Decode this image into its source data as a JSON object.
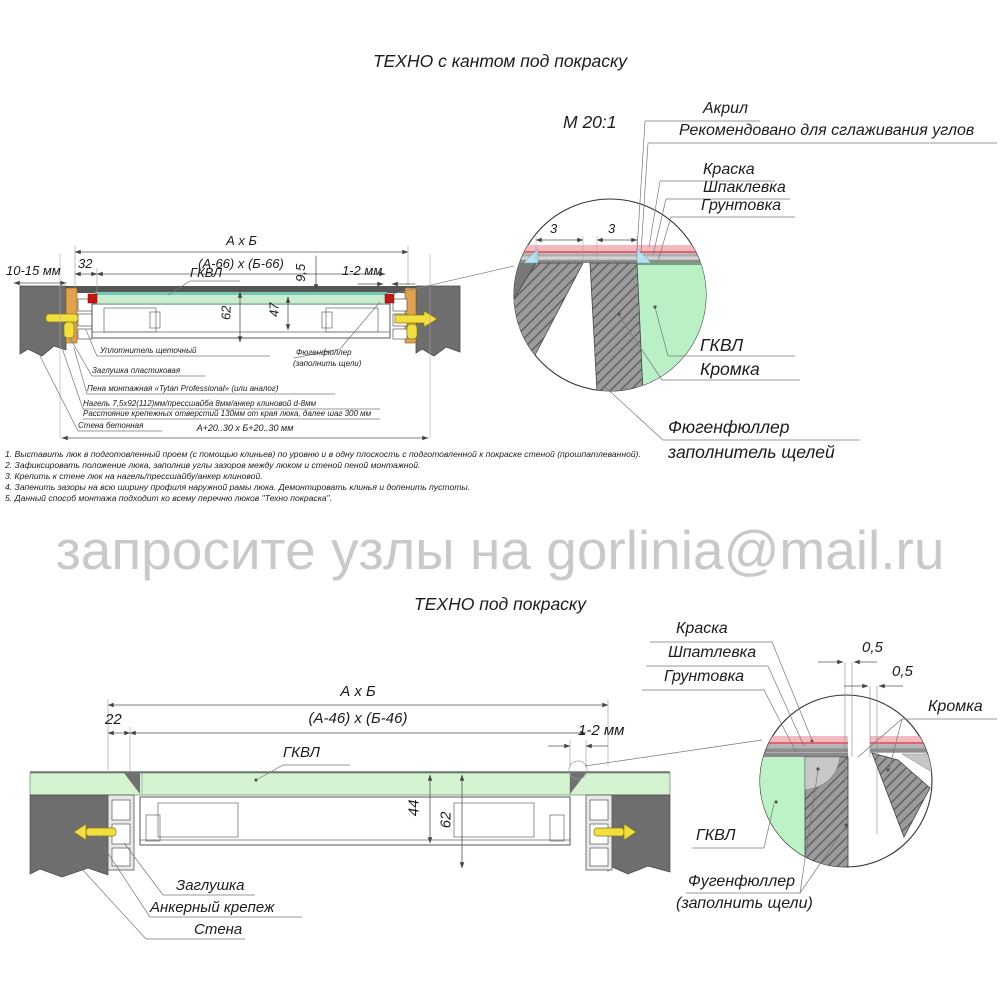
{
  "top": {
    "title": "ТЕХНО с кантом под покраску",
    "scale_label": "М 20:1",
    "callouts": {
      "akril": "Акрил",
      "akril_note": "Рекомендовано для сглаживания углов",
      "kraska": "Краска",
      "shpaklevka": "Шпаклевка",
      "gruntovka": "Грунтовка",
      "gkvl": "ГКВЛ",
      "kromka": "Кромка",
      "fugen_title": "Фюгенфюллер",
      "fugen_sub": "заполнитель щелей"
    },
    "dims": {
      "axb": "А х Б",
      "inner": "(А-66) х (Б-66)",
      "d32": "32",
      "d10_15": "10-15 мм",
      "gkvl": "ГКВЛ",
      "d95": "9,5",
      "d12": "1-2 мм",
      "d62": "62",
      "d47": "47",
      "d3_left": "3",
      "d3_right": "3",
      "outer": "А+20..30 х Б+20..30 мм"
    },
    "annotations": {
      "uplotnitel": "Уплотнитель щеточный",
      "zaglushka": "Заглушка пластиковая",
      "pena": "Пена монтажная «Tytan Professional» (или аналог)",
      "nagel": "Нагель 7,5х92(112)мм/прессшайба 8мм/анкер клиновой d-8мм",
      "rasstoyanie": "Расстояние крепежных отверстий 130мм от края люка, далее шаг 300 мм",
      "stena": "Стена бетонная",
      "fugen1": "Фюгенфюллер",
      "fugen2": "(заполнить щели)"
    }
  },
  "notes": [
    "1. Выставить люк в подготовленный проем (с помощью клиньев) по уровню и в одну плоскость с подготовленной к покраске стеной (прошпатлеванной).",
    "2. Зафиксировать положение люка, заполнив углы зазоров между люком и стеной пеной монтажной.",
    "3. Крепить к стене люк на нагель/прессшайбу/анкер клиновой.",
    "4. Запенить зазоры на всю ширину профиля наружной рамы люка. Демонтировать клинья и допенить пустоты.",
    "5. Данный способ монтажа подходит ко всему перечню люков \"Техно покраска\"."
  ],
  "watermark": "запросите узлы на gorlinia@mail.ru",
  "bottom": {
    "title": "ТЕХНО под покраску",
    "dims": {
      "axb": "А х Б",
      "inner": "(А-46) х (Б-46)",
      "d22": "22",
      "d12": "1-2 мм",
      "gkvl": "ГКВЛ",
      "d44": "44",
      "d62": "62",
      "d05a": "0,5",
      "d05b": "0,5"
    },
    "callouts": {
      "kraska": "Краска",
      "shpatlevka": "Шпатлевка",
      "gruntovka": "Грунтовка",
      "kromka": "Кромка",
      "gkvl": "ГКВЛ",
      "fugen1": "Фугенфюллер",
      "fugen2": "(заполнить щели)",
      "zaglushka": "Заглушка",
      "anker": "Анкерный крепеж",
      "stena": "Стена"
    }
  },
  "colors": {
    "wall": "#6e6e6e",
    "gkvl_green": "#c8edd1",
    "paint_pink": "#f3bac1",
    "acrylic_blue": "#b5e2f2",
    "anchor_yellow": "#f1df3e",
    "wood_orange": "#e3a14e",
    "sealant_red": "#c41414",
    "watermark_gray": "#c9c9c9"
  }
}
